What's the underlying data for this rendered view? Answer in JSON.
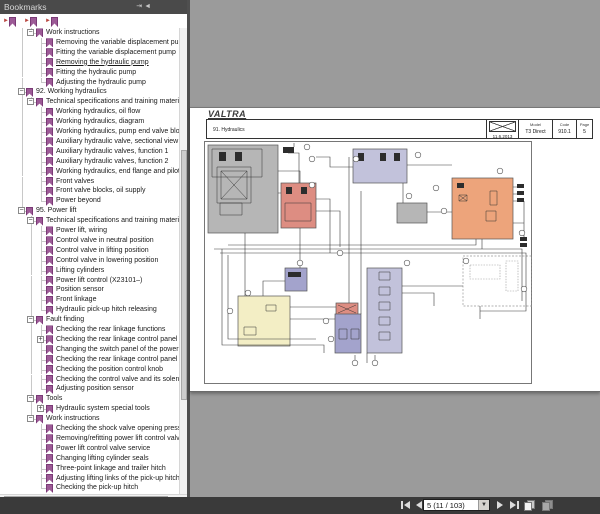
{
  "colors": {
    "panel_header_bg": "#4a4a4a",
    "doc_bg": "#9b9b9b",
    "toolbar_bg": "#3a3a3a",
    "bookmark_icon": "#9c5a96",
    "accent_red": "#b8443e",
    "tree_guide": "#c8c8c8"
  },
  "panel": {
    "title": "Bookmarks",
    "header_icons": [
      {
        "name": "pin-panel-icon",
        "glyph": "⇥"
      },
      {
        "name": "collapse-panel-icon",
        "glyph": "◄"
      }
    ]
  },
  "bookmarks": {
    "items": [
      {
        "label": "Work instructions",
        "lv": 1,
        "exp": "-"
      },
      {
        "label": "Removing the variable displacement pump",
        "lv": 2
      },
      {
        "label": "Fitting the variable displacement pump",
        "lv": 2
      },
      {
        "label": "Removing the hydraulic pump",
        "lv": 2,
        "sel": true
      },
      {
        "label": "Fitting the hydraulic pump",
        "lv": 2
      },
      {
        "label": "Adjusting the hydraulic pump",
        "lv": 2
      },
      {
        "label": "92. Working hydraulics",
        "lv": 0,
        "exp": "-"
      },
      {
        "label": "Technical specifications and training material",
        "lv": 1,
        "exp": "-"
      },
      {
        "label": "Working hydraulics, oil flow",
        "lv": 2
      },
      {
        "label": "Working hydraulics, diagram",
        "lv": 2
      },
      {
        "label": "Working hydraulics, pump end valve block",
        "lv": 2
      },
      {
        "label": "Auxiliary hydraulic valve, sectional view",
        "lv": 2
      },
      {
        "label": "Auxiliary hydraulic valves, function 1",
        "lv": 2
      },
      {
        "label": "Auxiliary hydraulic valves, function 2",
        "lv": 2
      },
      {
        "label": "Working hydraulics, end flange and pilot",
        "lv": 2
      },
      {
        "label": "Front valves",
        "lv": 2
      },
      {
        "label": "Front valve blocks, oil supply",
        "lv": 2
      },
      {
        "label": "Power beyond",
        "lv": 2
      },
      {
        "label": "95. Power lift",
        "lv": 0,
        "exp": "-"
      },
      {
        "label": "Technical specifications and training material",
        "lv": 1,
        "exp": "-"
      },
      {
        "label": "Power lift, wiring",
        "lv": 2
      },
      {
        "label": "Control valve in neutral position",
        "lv": 2
      },
      {
        "label": "Control valve in lifting position",
        "lv": 2
      },
      {
        "label": "Control valve in lowering position",
        "lv": 2
      },
      {
        "label": "Lifting cylinders",
        "lv": 2
      },
      {
        "label": "Power lift control (X23101–)",
        "lv": 2
      },
      {
        "label": "Position sensor",
        "lv": 2
      },
      {
        "label": "Front linkage",
        "lv": 2
      },
      {
        "label": "Hydraulic pick-up hitch releasing",
        "lv": 2
      },
      {
        "label": "Fault finding",
        "lv": 1,
        "exp": "-"
      },
      {
        "label": "Checking the rear linkage functions",
        "lv": 2
      },
      {
        "label": "Checking the rear linkage control panel",
        "lv": 2,
        "exp": "+"
      },
      {
        "label": "Changing the switch panel of the power lift",
        "lv": 2
      },
      {
        "label": "Checking the rear linkage control panel in",
        "lv": 2
      },
      {
        "label": "Checking the position control knob",
        "lv": 2
      },
      {
        "label": "Checking the control valve and its solenoids",
        "lv": 2
      },
      {
        "label": "Adjusting position sensor",
        "lv": 2
      },
      {
        "label": "Tools",
        "lv": 1,
        "exp": "-"
      },
      {
        "label": "Hydraulic system special tools",
        "lv": 2,
        "exp": "+"
      },
      {
        "label": "Work instructions",
        "lv": 1,
        "exp": "-"
      },
      {
        "label": "Checking the shock valve opening pressure",
        "lv": 2
      },
      {
        "label": "Removing/refitting power lift control valve",
        "lv": 2
      },
      {
        "label": "Power lift control valve service",
        "lv": 2
      },
      {
        "label": "Changing lifting cylinder seals",
        "lv": 2
      },
      {
        "label": "Three-point linkage and trailer hitch",
        "lv": 2
      },
      {
        "label": "Adjusting lifting links of the pick-up hitch",
        "lv": 2
      },
      {
        "label": "Checking the pick-up hitch",
        "lv": 2
      }
    ]
  },
  "document": {
    "logo": "VALTRA",
    "header": {
      "section": "91. Hydraulics",
      "date": "11.6.2013",
      "model_label": "Model",
      "model": "T3 Direct",
      "code_label": "Code",
      "code": "910.1",
      "page_label": "Page",
      "page": "5"
    }
  },
  "diagram": {
    "colors": {
      "gray": "#b6b6b6",
      "red": "#dd8d82",
      "lavender": "#c2c2db",
      "blue": "#a3a3cc",
      "yellow": "#f3eec5",
      "orange": "#eda47b"
    }
  },
  "toolbar": {
    "page_field": "5 (11 / 103)",
    "combo_arrow": "▼"
  }
}
